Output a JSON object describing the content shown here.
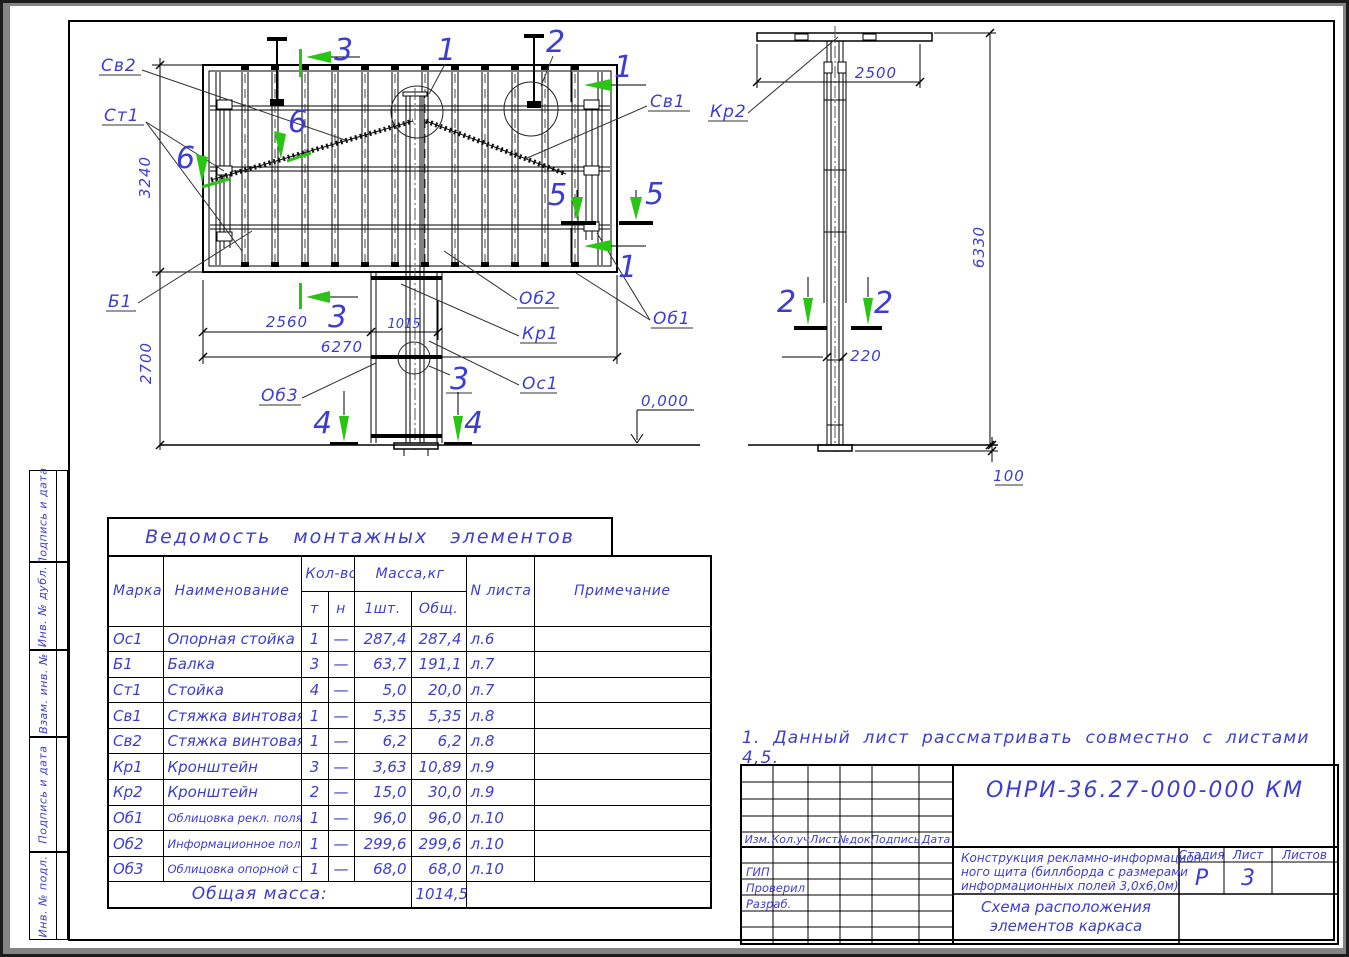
{
  "colors": {
    "background": "#848484",
    "sheet": "#ffffff",
    "line": "#000000",
    "annotation_blue": "#3d3dd2",
    "section_green": "#29c414"
  },
  "sheet": {
    "note": "1. Данный лист рассматривать совместно  с листами 4,5.",
    "sidebar_labels": [
      "Подпись и дата",
      "Инв. № дубл.",
      "Взам. инв. №",
      "Подпись и дата",
      "Инв. № подл."
    ]
  },
  "front_view": {
    "labels": {
      "sv2": "Св2",
      "st1": "Ст1",
      "b1": "Б1",
      "ob3": "Об3",
      "ob2": "Об2",
      "kr1": "Кр1",
      "os1": "Ос1",
      "ob1": "Об1",
      "sv1": "Св1"
    },
    "details": {
      "d1": "1",
      "d2": "2",
      "d3": "3"
    },
    "sections": {
      "s1": "1",
      "s3": "3",
      "s4": "4",
      "s5": "5",
      "s6": "6"
    },
    "dims": {
      "board_height": "3240",
      "clearance": "2700",
      "left_span": "2560",
      "stand_width": "1015",
      "total_width": "6270",
      "level": "0,000"
    }
  },
  "side_view": {
    "labels": {
      "kr2": "Кр2"
    },
    "sections": {
      "s2": "2"
    },
    "dims": {
      "top_width": "2500",
      "total_height": "6330",
      "mast_width": "220",
      "base_height": "100"
    }
  },
  "table": {
    "title": "Ведомость монтажных элементов",
    "col_marka": "Марка",
    "col_name": "Наименование",
    "col_qty": "Кол-во",
    "col_mass": "Масса,кг",
    "col_qty_t": "т",
    "col_qty_n": "н",
    "col_mass_one": "1шт.",
    "col_mass_total": "Общ.",
    "col_sheet": "N листа",
    "col_note": "Примечание",
    "rows": [
      {
        "mark": "Ос1",
        "name": "Опорная  стойка",
        "t": "1",
        "n": "—",
        "one": "287,4",
        "total": "287,4",
        "sheet": "л.6"
      },
      {
        "mark": "Б1",
        "name": "Балка",
        "t": "3",
        "n": "—",
        "one": "63,7",
        "total": "191,1",
        "sheet": "л.7"
      },
      {
        "mark": "Ст1",
        "name": "Стойка",
        "t": "4",
        "n": "—",
        "one": "5,0",
        "total": "20,0",
        "sheet": "л.7"
      },
      {
        "mark": "Св1",
        "name": "Стяжка  винтовая",
        "t": "1",
        "n": "—",
        "one": "5,35",
        "total": "5,35",
        "sheet": "л.8"
      },
      {
        "mark": "Св2",
        "name": "Стяжка  винтовая",
        "t": "1",
        "n": "—",
        "one": "6,2",
        "total": "6,2",
        "sheet": "л.8"
      },
      {
        "mark": "Кр1",
        "name": "Кронштейн",
        "t": "3",
        "n": "—",
        "one": "3,63",
        "total": "10,89",
        "sheet": "л.9"
      },
      {
        "mark": "Кр2",
        "name": "Кронштейн",
        "t": "2",
        "n": "—",
        "one": "15,0",
        "total": "30,0",
        "sheet": "л.9"
      },
      {
        "mark": "Об1",
        "name": "Облицовка  рекл.  поля",
        "t": "1",
        "n": "—",
        "one": "96,0",
        "total": "96,0",
        "sheet": "л.10"
      },
      {
        "mark": "Об2",
        "name": "Информационное  поле",
        "t": "1",
        "n": "—",
        "one": "299,6",
        "total": "299,6",
        "sheet": "л.10"
      },
      {
        "mark": "Об3",
        "name": "Облицовка  опорной  стойки",
        "t": "1",
        "n": "—",
        "one": "68,0",
        "total": "68,0",
        "sheet": "л.10"
      }
    ],
    "total_label": "Общая  масса:",
    "total_value": "1014,54"
  },
  "title_block": {
    "designation": "ОНРИ-36.27-000-000  КМ",
    "rev_cols": [
      "Изм.",
      "Кол.уч",
      "Лист",
      "№док.",
      "Подпись",
      "Дата"
    ],
    "roles": [
      "ГИП",
      "Проверил",
      "Разраб."
    ],
    "description_lines": [
      "Конструкция  рекламно-информацион-",
      "ного  щита  (биллборда  с  размерами",
      "информационных  полей  3,0х6,0м)"
    ],
    "stage_label": "Стадия",
    "sheet_label": "Лист",
    "sheets_label": "Листов",
    "stage": "Р",
    "sheet_no": "3",
    "sheets_total": "",
    "subtitle_lines": [
      "Схема  расположения",
      "элементов  каркаса"
    ]
  }
}
